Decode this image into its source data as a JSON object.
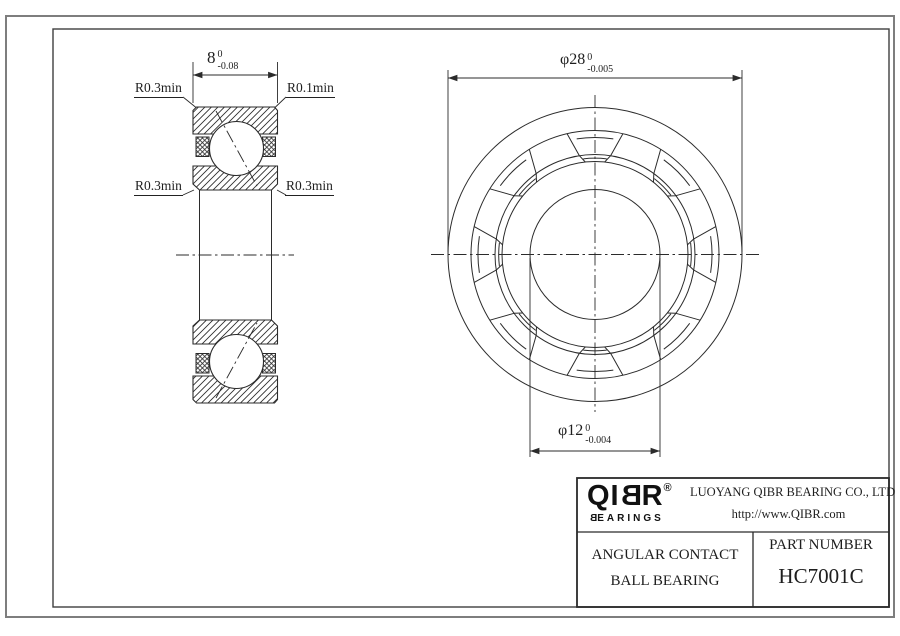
{
  "colors": {
    "line": "#2b2b2b",
    "outer_frame": "#7e7e7e",
    "inner_frame": "#3f3f3f",
    "background": "#ffffff"
  },
  "drawing": {
    "section_view": {
      "dim_width": {
        "value": "8",
        "tol_upper": "0",
        "tol_lower": "-0.08"
      },
      "radius_labels": {
        "top_left": "R0.3min",
        "top_right": "R0.1min",
        "mid_left": "R0.3min",
        "mid_right": "R0.3min"
      }
    },
    "front_view": {
      "dim_outer_diameter": {
        "value": "φ28",
        "tol_upper": "0",
        "tol_lower": "-0.005"
      },
      "dim_bore_diameter": {
        "value": "φ12",
        "tol_upper": "0",
        "tol_lower": "-0.004"
      }
    }
  },
  "title_block": {
    "logo": {
      "part1": "QI",
      "mirrored_b": "B",
      "part2": "R",
      "registered": "®",
      "sub_b": "B",
      "sub_rest": "EARINGS"
    },
    "company_name": "LUOYANG QIBR BEARING CO., LTD",
    "website": "http://www.QIBR.com",
    "product_line1": "ANGULAR CONTACT",
    "product_line2": "BALL BEARING",
    "part_number_label": "PART NUMBER",
    "part_number": "HC7001C"
  }
}
